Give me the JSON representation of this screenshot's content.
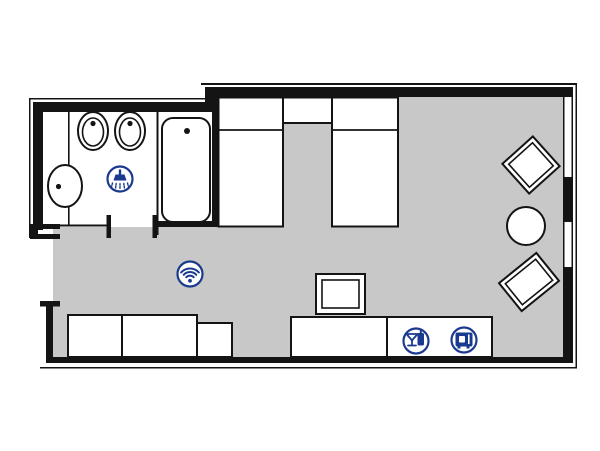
{
  "meta": {
    "title": "Hotel room floor plan",
    "type": "floor-plan",
    "visible_text": []
  },
  "colors": {
    "background": "#ffffff",
    "floor": "#c8c8c8",
    "wall": "#141414",
    "outline": "#141414",
    "furniture_fill": "#ffffff",
    "icon_blue": "#1a3a8f"
  },
  "rooms": {
    "bathroom": {
      "name": "bathroom",
      "fixtures": [
        "toilet",
        "bidet",
        "washbasin",
        "bathtub",
        "shower"
      ]
    },
    "main_room": {
      "name": "bedroom-living-area",
      "furniture": [
        "twin-bed-left",
        "nightstand",
        "twin-bed-right",
        "luggage-bench",
        "lowboard",
        "bench-small",
        "tv-unit",
        "desk-sideboard",
        "minibar-cabinet",
        "armchair-upper",
        "round-table",
        "armchair-lower"
      ],
      "architecture": [
        "entrance-door-opening",
        "bathroom-door-opening",
        "window-upper",
        "window-lower"
      ]
    }
  },
  "amenity_icons": [
    {
      "name": "shower-icon",
      "meaning": "shower"
    },
    {
      "name": "wifi-icon",
      "meaning": "wireless internet"
    },
    {
      "name": "minibar-icon",
      "meaning": "minibar"
    },
    {
      "name": "safe-icon",
      "meaning": "room safe"
    }
  ]
}
